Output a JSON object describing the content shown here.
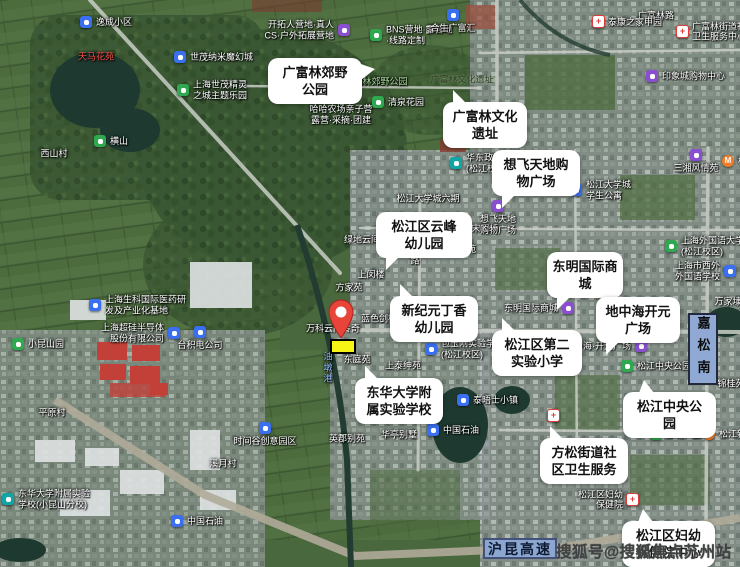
{
  "watermark": {
    "text": "搜狐号@搜狐焦点苏州站"
  },
  "map": {
    "banners": {
      "highway": {
        "label": "沪昆高速",
        "x": 483,
        "y": 538,
        "w": 74,
        "h": 21
      },
      "road_sign": {
        "label": "嘉松南",
        "x": 688,
        "y": 313,
        "w": 30,
        "h": 72
      }
    },
    "pin": {
      "x": 341,
      "y": 338,
      "color": "#e8443a"
    },
    "plot": {
      "x": 330,
      "y": 339,
      "w": 26,
      "h": 15,
      "color": "#f6f513"
    },
    "callouts": [
      {
        "lines": [
          "广富林郊野",
          "公园"
        ],
        "x": 268,
        "y": 58,
        "w": 84,
        "tail": "r"
      },
      {
        "lines": [
          "广富林文化",
          "遗址"
        ],
        "x": 443,
        "y": 102,
        "w": 74,
        "tail": "tl"
      },
      {
        "lines": [
          "想飞天地购",
          "物广场"
        ],
        "x": 492,
        "y": 150,
        "w": 78,
        "tail": "bl"
      },
      {
        "lines": [
          "松江区云峰",
          "幼儿园"
        ],
        "x": 376,
        "y": 212,
        "w": 86,
        "tail": "bl"
      },
      {
        "lines": [
          "新纪元丁香",
          "幼儿园"
        ],
        "x": 390,
        "y": 296,
        "w": 78,
        "tail": "tl"
      },
      {
        "lines": [
          "东明国际商",
          "城"
        ],
        "x": 547,
        "y": 252,
        "w": 66,
        "tail": "bl"
      },
      {
        "lines": [
          "地中海开元",
          "广场"
        ],
        "x": 596,
        "y": 297,
        "w": 74,
        "tail": "bl"
      },
      {
        "lines": [
          "松江区第二",
          "实验小学"
        ],
        "x": 492,
        "y": 330,
        "w": 80,
        "tail": "tl"
      },
      {
        "lines": [
          "东华大学附",
          "属实验学校"
        ],
        "x": 355,
        "y": 378,
        "w": 78,
        "tail": "tl"
      },
      {
        "lines": [
          "松江中央公",
          "园"
        ],
        "x": 623,
        "y": 392,
        "w": 83,
        "tail": "t"
      },
      {
        "lines": [
          "方松街道社",
          "区卫生服务"
        ],
        "x": 540,
        "y": 438,
        "w": 78,
        "tail": "tl"
      },
      {
        "lines": [
          "松江区妇幼",
          "保健院中心"
        ],
        "x": 622,
        "y": 521,
        "w": 83,
        "tail": "t"
      }
    ],
    "pois": [
      {
        "icon": "blue",
        "x": 86,
        "y": 22,
        "side": "right",
        "label": [
          "逸成小区"
        ]
      },
      {
        "icon": "blue",
        "x": 180,
        "y": 57,
        "side": "right",
        "label": [
          "世茂纳米魔幻城"
        ]
      },
      {
        "icon": "park",
        "x": 183,
        "y": 90,
        "side": "right",
        "label": [
          "上海世茂精灵",
          "之城主题乐园"
        ]
      },
      {
        "icon": "park",
        "x": 100,
        "y": 141,
        "side": "right",
        "label": [
          "横山"
        ]
      },
      {
        "icon": "purple",
        "x": 344,
        "y": 30,
        "side": "left",
        "label": [
          "开拓人营地·真人",
          "CS·户外拓展营地"
        ]
      },
      {
        "icon": "park",
        "x": 376,
        "y": 35,
        "side": "right",
        "label": [
          "BNS营地·露营地",
          "·线路定制"
        ]
      },
      {
        "icon": "blue",
        "x": 453,
        "y": 15,
        "side": "below",
        "label": [
          "合生广富汇"
        ]
      },
      {
        "icon": "purple",
        "x": 341,
        "y": 96,
        "side": "below",
        "label": [
          "哈哈农场亲子营",
          "露营·采摘·团建"
        ]
      },
      {
        "icon": "park",
        "x": 378,
        "y": 102,
        "side": "right",
        "label": [
          "清泉花园"
        ]
      },
      {
        "icon": "hospital",
        "x": 598,
        "y": 21,
        "side": "right",
        "label": [
          "泰康之家申园"
        ]
      },
      {
        "icon": "hospital",
        "x": 682,
        "y": 31,
        "side": "right",
        "label": [
          "广富林街道社区",
          "卫生服务中心"
        ]
      },
      {
        "icon": "purple",
        "x": 652,
        "y": 76,
        "side": "right",
        "label": [
          "印象城购物中心"
        ]
      },
      {
        "icon": "school",
        "x": 456,
        "y": 163,
        "side": "right",
        "label": [
          "华东政法大学",
          "(松江校区)"
        ]
      },
      {
        "icon": "purple",
        "x": 498,
        "y": 206,
        "side": "below",
        "label": [
          "想飞天地",
          "购物广场"
        ]
      },
      {
        "icon": "blue",
        "x": 430,
        "y": 249,
        "side": "right",
        "label": [
          "文翔名苑"
        ]
      },
      {
        "icon": "blue",
        "x": 576,
        "y": 190,
        "side": "right",
        "label": [
          "松江大学城",
          "学生公寓"
        ]
      },
      {
        "icon": "purple",
        "x": 696,
        "y": 155,
        "side": "below",
        "label": [
          "三湘风情苑"
        ]
      },
      {
        "icon": "metro",
        "x": 728,
        "y": 161,
        "side": "right",
        "label": [
          "松江大学城"
        ]
      },
      {
        "icon": "park",
        "x": 671,
        "y": 246,
        "side": "right",
        "label": [
          "上海外国语大学",
          "(松江校区)"
        ]
      },
      {
        "icon": "blue",
        "x": 730,
        "y": 271,
        "side": "left",
        "label": [
          "上海市西外",
          "外国语学校"
        ]
      },
      {
        "icon": "purple",
        "x": 568,
        "y": 308,
        "side": "left",
        "label": [
          "东明国际商城"
        ]
      },
      {
        "icon": "blue",
        "x": 431,
        "y": 349,
        "side": "right",
        "label": [
          "包玉刚实验学校",
          "(松江校区)"
        ]
      },
      {
        "icon": "purple",
        "x": 641,
        "y": 346,
        "side": "left",
        "label": [
          "地中海·开元广场"
        ]
      },
      {
        "icon": "park",
        "x": 627,
        "y": 366,
        "side": "right",
        "label": [
          "松江中央公园"
        ]
      },
      {
        "icon": "blue",
        "x": 463,
        "y": 400,
        "side": "right",
        "label": [
          "泰晤士小镇"
        ]
      },
      {
        "icon": "blue",
        "x": 433,
        "y": 430,
        "side": "right",
        "label": [
          "中国石油"
        ]
      },
      {
        "icon": "blue",
        "x": 265,
        "y": 428,
        "side": "below",
        "label": [
          "时间谷创意园区"
        ]
      },
      {
        "icon": "blue",
        "x": 200,
        "y": 332,
        "side": "below",
        "label": [
          "台积电公司"
        ]
      },
      {
        "icon": "blue",
        "x": 174,
        "y": 333,
        "side": "left",
        "label": [
          "上海超硅半导体",
          "股份有限公司"
        ]
      },
      {
        "icon": "blue",
        "x": 95,
        "y": 305,
        "side": "right",
        "label": [
          "上海生科国际医药研",
          "发及产业化基地"
        ]
      },
      {
        "icon": "park",
        "x": 18,
        "y": 344,
        "side": "right",
        "label": [
          "小昆山园"
        ]
      },
      {
        "icon": "metro",
        "x": 709,
        "y": 434,
        "side": "right",
        "label": [
          "松江新城"
        ]
      },
      {
        "icon": "park",
        "x": 656,
        "y": 434,
        "side": "right",
        "label": [
          "思贤公园"
        ]
      },
      {
        "icon": "hospital",
        "x": 632,
        "y": 499,
        "side": "left",
        "label": [
          "松江区妇幼",
          "保健院"
        ]
      },
      {
        "icon": "hospital",
        "x": 553,
        "y": 415,
        "side": "below",
        "label": []
      },
      {
        "icon": "blue",
        "x": 177,
        "y": 521,
        "side": "right",
        "label": [
          "中国石油"
        ]
      },
      {
        "icon": "school",
        "x": 8,
        "y": 499,
        "side": "right",
        "label": [
          "东华大学附属实验",
          "学校(小昆山分校)"
        ]
      }
    ],
    "labels": [
      {
        "text": "天马花苑",
        "x": 96,
        "y": 57,
        "color": "red"
      },
      {
        "text": "西山村",
        "x": 54,
        "y": 154,
        "color": "white"
      },
      {
        "text": "三湾里",
        "x": 293,
        "y": 94,
        "color": "white"
      },
      {
        "text": "广富林郊野公园",
        "x": 376,
        "y": 82,
        "color": "park"
      },
      {
        "text": "广富林文化遗址",
        "x": 462,
        "y": 80,
        "color": "dark"
      },
      {
        "text": "松江大学城六期",
        "x": 428,
        "y": 199,
        "color": "white"
      },
      {
        "text": "宋家桥",
        "x": 485,
        "y": 229,
        "color": "white"
      },
      {
        "text": "上闵楼",
        "x": 371,
        "y": 275,
        "color": "white"
      },
      {
        "text": "方家苑",
        "x": 349,
        "y": 288,
        "color": "white"
      },
      {
        "text": "绿地云间合苑",
        "x": 371,
        "y": 240,
        "color": "white"
      },
      {
        "text": "万科云间传奇",
        "x": 333,
        "y": 329,
        "color": "white"
      },
      {
        "text": "蓝色剑桥",
        "x": 379,
        "y": 319,
        "color": "white"
      },
      {
        "text": "东庭苑",
        "x": 357,
        "y": 360,
        "color": "white"
      },
      {
        "text": "上泰绅苑",
        "x": 403,
        "y": 366,
        "color": "white"
      },
      {
        "text": "华亭别墅",
        "x": 399,
        "y": 435,
        "color": "white"
      },
      {
        "text": "英郡别苑",
        "x": 347,
        "y": 439,
        "color": "white"
      },
      {
        "text": "万家埭",
        "x": 728,
        "y": 302,
        "color": "white"
      },
      {
        "text": "锦桂苑",
        "x": 731,
        "y": 384,
        "color": "white"
      },
      {
        "text": "平原村",
        "x": 52,
        "y": 413,
        "color": "white"
      },
      {
        "text": "溪月村",
        "x": 223,
        "y": 464,
        "color": "white"
      },
      {
        "text": "广富林路",
        "x": 656,
        "y": 16,
        "color": "white"
      },
      {
        "text": "油墩港",
        "x": 327,
        "y": 368,
        "color": "water",
        "vertical": true
      },
      {
        "text": "文汇路",
        "x": 414,
        "y": 250,
        "color": "white",
        "vertical": true
      }
    ]
  }
}
